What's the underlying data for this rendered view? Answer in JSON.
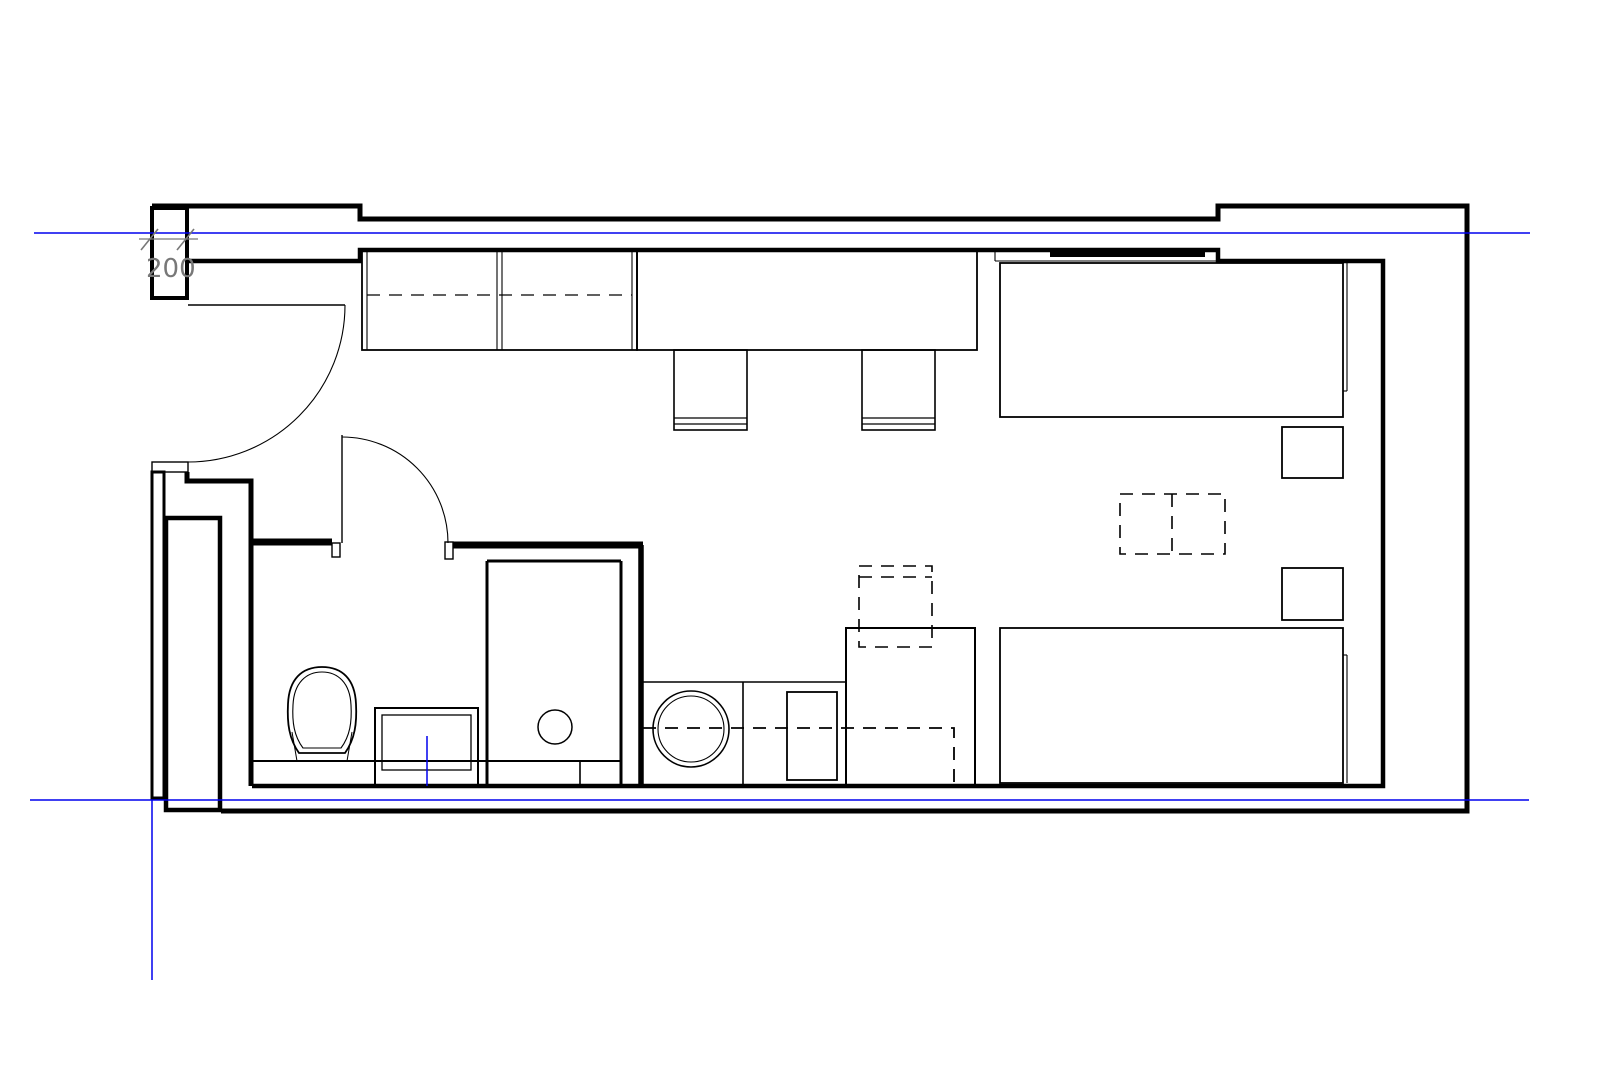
{
  "title": "studio-apartment-floor-plan",
  "canvas": {
    "width": 1615,
    "height": 1077,
    "background": "#ffffff"
  },
  "colors": {
    "line": "#000000",
    "axis": "#0000ee",
    "dim": "#787878"
  },
  "dimension": {
    "label": "200"
  },
  "plan": {
    "shapes": [
      {
        "name": "outer-wall",
        "type": "polyline",
        "cls": "ln",
        "attrs": {
          "points": "152,206 360,206 360,219 1218,219 1218,206 1467,206 1467,811 221,811",
          "stroke-width": 5
        }
      },
      {
        "name": "entry-pier",
        "type": "rect",
        "cls": "ln whitefill",
        "attrs": {
          "x": 152,
          "y": 208,
          "width": 35,
          "height": 90,
          "stroke-width": 4
        }
      },
      {
        "name": "inner-wall",
        "type": "polyline",
        "cls": "ln",
        "attrs": {
          "points": "188,261 360,261 360,250 1218,250 1218,261 1383,261 1383,786 252,786",
          "stroke-width": 4.5
        }
      },
      {
        "name": "left-wall-lower",
        "type": "rect",
        "cls": "ln",
        "attrs": {
          "x": 152,
          "y": 472,
          "width": 12,
          "height": 326,
          "stroke-width": 3
        }
      },
      {
        "name": "entry-jamb",
        "type": "rect",
        "cls": "ln",
        "attrs": {
          "x": 152,
          "y": 462,
          "width": 36,
          "height": 10,
          "stroke-width": 1.4
        }
      },
      {
        "name": "entry-step-wall",
        "type": "polyline",
        "cls": "ln",
        "attrs": {
          "points": "187,472 187,481 251,481 251,786",
          "stroke-width": 5
        }
      },
      {
        "name": "shaft-column",
        "type": "rect",
        "cls": "ln",
        "attrs": {
          "x": 166,
          "y": 518,
          "width": 54,
          "height": 292,
          "stroke-width": 4.5
        }
      },
      {
        "name": "bath-wall-top-left",
        "type": "line",
        "cls": "ln",
        "attrs": {
          "x1": 251,
          "y1": 542,
          "x2": 332,
          "y2": 542,
          "stroke-width": 7
        }
      },
      {
        "name": "bath-door-jamb-left",
        "type": "rect",
        "cls": "ln",
        "attrs": {
          "x": 332,
          "y": 543,
          "width": 8,
          "height": 14,
          "stroke-width": 1.4
        }
      },
      {
        "name": "bath-door-jamb-right",
        "type": "rect",
        "cls": "ln",
        "attrs": {
          "x": 445,
          "y": 542,
          "width": 8,
          "height": 17,
          "stroke-width": 1.4
        }
      },
      {
        "name": "bath-wall-top-right",
        "type": "line",
        "cls": "ln",
        "attrs": {
          "x1": 453,
          "y1": 545,
          "x2": 643,
          "y2": 545,
          "stroke-width": 7
        }
      },
      {
        "name": "bath-wall-right",
        "type": "line",
        "cls": "ln",
        "attrs": {
          "x1": 641,
          "y1": 545,
          "x2": 641,
          "y2": 786,
          "stroke-width": 5.5
        }
      },
      {
        "name": "entry-door-leaf",
        "type": "line",
        "cls": "ln",
        "attrs": {
          "x1": 188,
          "y1": 305,
          "x2": 345,
          "y2": 305,
          "stroke-width": 1.4
        }
      },
      {
        "name": "entry-door-swing",
        "type": "path",
        "cls": "ln",
        "attrs": {
          "d": "M345,305 A157,157 0 0 1 188,462",
          "stroke-width": 1.1
        }
      },
      {
        "name": "bath-door-leaf",
        "type": "line",
        "cls": "ln",
        "attrs": {
          "x1": 342,
          "y1": 435,
          "x2": 342,
          "y2": 543,
          "stroke-width": 1.4
        }
      },
      {
        "name": "bath-door-swing",
        "type": "path",
        "cls": "ln",
        "attrs": {
          "d": "M342,437 A106,106 0 0 1 448,543",
          "stroke-width": 1.1
        }
      },
      {
        "name": "shower-divider",
        "type": "line",
        "cls": "ln",
        "attrs": {
          "x1": 487,
          "y1": 561,
          "x2": 487,
          "y2": 785,
          "stroke-width": 3
        }
      },
      {
        "name": "shower-top",
        "type": "line",
        "cls": "ln",
        "attrs": {
          "x1": 487,
          "y1": 561,
          "x2": 621,
          "y2": 561,
          "stroke-width": 3
        }
      },
      {
        "name": "shower-right",
        "type": "line",
        "cls": "ln",
        "attrs": {
          "x1": 621,
          "y1": 561,
          "x2": 621,
          "y2": 785,
          "stroke-width": 3
        }
      },
      {
        "name": "bath-floor-strip",
        "type": "line",
        "cls": "ln",
        "attrs": {
          "x1": 253,
          "y1": 761,
          "x2": 621,
          "y2": 761,
          "stroke-width": 2
        }
      },
      {
        "name": "strip-divider",
        "type": "line",
        "cls": "ln",
        "attrs": {
          "x1": 580,
          "y1": 761,
          "x2": 580,
          "y2": 785,
          "stroke-width": 1.6
        }
      },
      {
        "name": "shower-drain",
        "type": "circle",
        "cls": "ln",
        "attrs": {
          "cx": 555,
          "cy": 727,
          "r": 17,
          "stroke-width": 1.5
        }
      },
      {
        "name": "toilet-outer",
        "type": "path",
        "cls": "ln",
        "attrs": {
          "d": "M299,753 L345,753 C355,739 357,723 356,704 C355,679 342,667 322,667 C302,667 289,679 288,704 C287,723 289,739 299,753 Z",
          "stroke-width": 1.8
        }
      },
      {
        "name": "toilet-inner",
        "type": "path",
        "cls": "ln",
        "attrs": {
          "d": "M303,748 L341,748 C350,736 352,722 351,705 C350,683 338,672 322,672 C306,672 294,683 293,705 C292,722 294,736 303,748 Z",
          "stroke-width": 1.1
        }
      },
      {
        "name": "toilet-leg-left",
        "type": "line",
        "cls": "ln",
        "attrs": {
          "x1": 292,
          "y1": 732,
          "x2": 297,
          "y2": 761,
          "stroke-width": 1
        }
      },
      {
        "name": "toilet-leg-right",
        "type": "line",
        "cls": "ln",
        "attrs": {
          "x1": 352,
          "y1": 732,
          "x2": 347,
          "y2": 761,
          "stroke-width": 1
        }
      },
      {
        "name": "vanity-outer",
        "type": "rect",
        "cls": "ln",
        "attrs": {
          "x": 375,
          "y": 708,
          "width": 103,
          "height": 78,
          "stroke-width": 2
        }
      },
      {
        "name": "vanity-inner",
        "type": "rect",
        "cls": "ln",
        "attrs": {
          "x": 382,
          "y": 715,
          "width": 89,
          "height": 55,
          "stroke-width": 1.3
        }
      },
      {
        "name": "vanity-centerline",
        "type": "line",
        "cls": "blue",
        "attrs": {
          "x1": 427,
          "y1": 736,
          "x2": 427,
          "y2": 786,
          "stroke-width": 1.5
        }
      },
      {
        "name": "kitchen-counter-edge",
        "type": "line",
        "cls": "ln",
        "attrs": {
          "x1": 643,
          "y1": 682,
          "x2": 846,
          "y2": 682,
          "stroke-width": 1.6
        }
      },
      {
        "name": "kitchen-divider",
        "type": "line",
        "cls": "ln",
        "attrs": {
          "x1": 743,
          "y1": 682,
          "x2": 743,
          "y2": 785,
          "stroke-width": 1.6
        }
      },
      {
        "name": "washer-door-outer",
        "type": "circle",
        "cls": "ln",
        "attrs": {
          "cx": 691,
          "cy": 729,
          "r": 38,
          "stroke-width": 1.6
        }
      },
      {
        "name": "washer-door-inner",
        "type": "circle",
        "cls": "ln",
        "attrs": {
          "cx": 691,
          "cy": 729,
          "r": 33,
          "stroke-width": 1.1
        }
      },
      {
        "name": "kitchen-sink",
        "type": "rect",
        "cls": "ln",
        "attrs": {
          "x": 787,
          "y": 692,
          "width": 50,
          "height": 88,
          "stroke-width": 1.8
        }
      },
      {
        "name": "kitchen-tall-cabinet",
        "type": "rect",
        "cls": "ln",
        "attrs": {
          "x": 846,
          "y": 628,
          "width": 129,
          "height": 158,
          "stroke-width": 2
        }
      },
      {
        "name": "kitchen-counter-hidden",
        "type": "polyline",
        "cls": "ln dashed",
        "attrs": {
          "points": "643,728 954,728 954,785",
          "stroke-width": 1.8
        }
      },
      {
        "name": "wall-cabinet-hidden",
        "type": "rect",
        "cls": "ln dashed",
        "attrs": {
          "x": 859,
          "y": 566,
          "width": 73,
          "height": 81,
          "stroke-width": 1.6
        }
      },
      {
        "name": "wall-cabinet-hidden-line",
        "type": "line",
        "cls": "ln dashed",
        "attrs": {
          "x1": 859,
          "y1": 577,
          "x2": 932,
          "y2": 577,
          "stroke-width": 1.6
        }
      },
      {
        "name": "wardrobe",
        "type": "rect",
        "cls": "ln",
        "attrs": {
          "x": 362,
          "y": 250,
          "width": 275,
          "height": 100,
          "stroke-width": 1.8
        }
      },
      {
        "name": "wardrobe-side-left",
        "type": "line",
        "cls": "ln",
        "attrs": {
          "x1": 367,
          "y1": 250,
          "x2": 367,
          "y2": 350,
          "stroke-width": 1.1
        }
      },
      {
        "name": "wardrobe-divider-a",
        "type": "line",
        "cls": "ln",
        "attrs": {
          "x1": 497,
          "y1": 250,
          "x2": 497,
          "y2": 350,
          "stroke-width": 1.1
        }
      },
      {
        "name": "wardrobe-divider-b",
        "type": "line",
        "cls": "ln",
        "attrs": {
          "x1": 502,
          "y1": 250,
          "x2": 502,
          "y2": 350,
          "stroke-width": 1.1
        }
      },
      {
        "name": "wardrobe-side-right",
        "type": "line",
        "cls": "ln",
        "attrs": {
          "x1": 632,
          "y1": 250,
          "x2": 632,
          "y2": 350,
          "stroke-width": 1.1
        }
      },
      {
        "name": "wardrobe-rail",
        "type": "line",
        "cls": "ln dashed",
        "attrs": {
          "x1": 367,
          "y1": 295,
          "x2": 632,
          "y2": 295,
          "stroke-width": 1.3
        }
      },
      {
        "name": "desk",
        "type": "rect",
        "cls": "ln",
        "attrs": {
          "x": 637,
          "y": 250,
          "width": 340,
          "height": 100,
          "stroke-width": 1.8
        }
      },
      {
        "name": "chair-1",
        "type": "rect",
        "cls": "ln",
        "attrs": {
          "x": 674,
          "y": 350,
          "width": 73,
          "height": 80,
          "stroke-width": 1.6
        }
      },
      {
        "name": "chair-1-back-a",
        "type": "line",
        "cls": "ln",
        "attrs": {
          "x1": 674,
          "y1": 418,
          "x2": 747,
          "y2": 418,
          "stroke-width": 1.3
        }
      },
      {
        "name": "chair-1-back-b",
        "type": "line",
        "cls": "ln",
        "attrs": {
          "x1": 674,
          "y1": 424,
          "x2": 747,
          "y2": 424,
          "stroke-width": 1.3
        }
      },
      {
        "name": "chair-2",
        "type": "rect",
        "cls": "ln",
        "attrs": {
          "x": 862,
          "y": 350,
          "width": 73,
          "height": 80,
          "stroke-width": 1.6
        }
      },
      {
        "name": "chair-2-back-a",
        "type": "line",
        "cls": "ln",
        "attrs": {
          "x1": 862,
          "y1": 418,
          "x2": 935,
          "y2": 418,
          "stroke-width": 1.3
        }
      },
      {
        "name": "chair-2-back-b",
        "type": "line",
        "cls": "ln",
        "attrs": {
          "x1": 862,
          "y1": 424,
          "x2": 935,
          "y2": 424,
          "stroke-width": 1.3
        }
      },
      {
        "name": "headboard-shelf-left",
        "type": "line",
        "cls": "ln",
        "attrs": {
          "x1": 995,
          "y1": 250,
          "x2": 995,
          "y2": 261,
          "stroke-width": 1.1
        }
      },
      {
        "name": "headboard-shelf-bottom",
        "type": "line",
        "cls": "ln",
        "attrs": {
          "x1": 995,
          "y1": 261,
          "x2": 1218,
          "y2": 261,
          "stroke-width": 1.1
        }
      },
      {
        "name": "headboard-bar",
        "type": "rect",
        "cls": "fillblack",
        "attrs": {
          "x": 1050,
          "y": 252,
          "width": 155,
          "height": 5
        }
      },
      {
        "name": "bed-top",
        "type": "rect",
        "cls": "ln",
        "attrs": {
          "x": 1000,
          "y": 263,
          "width": 343,
          "height": 154,
          "stroke-width": 1.8
        }
      },
      {
        "name": "bed-top-rail",
        "type": "line",
        "cls": "ln",
        "attrs": {
          "x1": 1347,
          "y1": 263,
          "x2": 1347,
          "y2": 391,
          "stroke-width": 1.1
        }
      },
      {
        "name": "bed-top-rail-end",
        "type": "line",
        "cls": "ln",
        "attrs": {
          "x1": 1343,
          "y1": 391,
          "x2": 1347,
          "y2": 391,
          "stroke-width": 1.1
        }
      },
      {
        "name": "nightstand-upper",
        "type": "rect",
        "cls": "ln",
        "attrs": {
          "x": 1282,
          "y": 427,
          "width": 61,
          "height": 51,
          "stroke-width": 1.8
        }
      },
      {
        "name": "nightstand-lower",
        "type": "rect",
        "cls": "ln",
        "attrs": {
          "x": 1282,
          "y": 568,
          "width": 61,
          "height": 52,
          "stroke-width": 1.8
        }
      },
      {
        "name": "table-hidden",
        "type": "rect",
        "cls": "ln dashed",
        "attrs": {
          "x": 1120,
          "y": 494,
          "width": 105,
          "height": 60,
          "stroke-width": 1.6
        }
      },
      {
        "name": "table-hidden-divider",
        "type": "line",
        "cls": "ln dashed",
        "attrs": {
          "x1": 1172,
          "y1": 494,
          "x2": 1172,
          "y2": 554,
          "stroke-width": 1.6
        }
      },
      {
        "name": "bed-bottom",
        "type": "rect",
        "cls": "ln",
        "attrs": {
          "x": 1000,
          "y": 628,
          "width": 343,
          "height": 155,
          "stroke-width": 1.8
        }
      },
      {
        "name": "bed-bottom-rail",
        "type": "line",
        "cls": "ln",
        "attrs": {
          "x1": 1347,
          "y1": 655,
          "x2": 1347,
          "y2": 783,
          "stroke-width": 1.1
        }
      },
      {
        "name": "bed-bottom-rail-end",
        "type": "line",
        "cls": "ln",
        "attrs": {
          "x1": 1343,
          "y1": 655,
          "x2": 1347,
          "y2": 655,
          "stroke-width": 1.1
        }
      },
      {
        "name": "axis-line-top",
        "type": "line",
        "cls": "blue",
        "attrs": {
          "x1": 34,
          "y1": 233,
          "x2": 1530,
          "y2": 233,
          "stroke-width": 1.5
        }
      },
      {
        "name": "axis-line-bottom",
        "type": "line",
        "cls": "blue",
        "attrs": {
          "x1": 30,
          "y1": 800,
          "x2": 1529,
          "y2": 800,
          "stroke-width": 1.5
        }
      },
      {
        "name": "axis-line-vertical",
        "type": "line",
        "cls": "blue",
        "attrs": {
          "x1": 152,
          "y1": 800,
          "x2": 152,
          "y2": 980,
          "stroke-width": 1.5
        }
      },
      {
        "name": "dim-line",
        "type": "line",
        "cls": "gray",
        "attrs": {
          "x1": 139,
          "y1": 239,
          "x2": 198,
          "y2": 239,
          "stroke-width": 1.2
        }
      },
      {
        "name": "dim-tick-left",
        "type": "line",
        "cls": "gray",
        "attrs": {
          "x1": 141,
          "y1": 250,
          "x2": 158,
          "y2": 229,
          "stroke-width": 1.6
        }
      },
      {
        "name": "dim-tick-right",
        "type": "line",
        "cls": "gray",
        "attrs": {
          "x1": 177,
          "y1": 250,
          "x2": 194,
          "y2": 229,
          "stroke-width": 1.6
        }
      },
      {
        "name": "dim-label",
        "type": "text",
        "cls": "dim-text",
        "bind": "dimension.label",
        "attrs": {
          "x": 146,
          "y": 277
        }
      }
    ]
  }
}
